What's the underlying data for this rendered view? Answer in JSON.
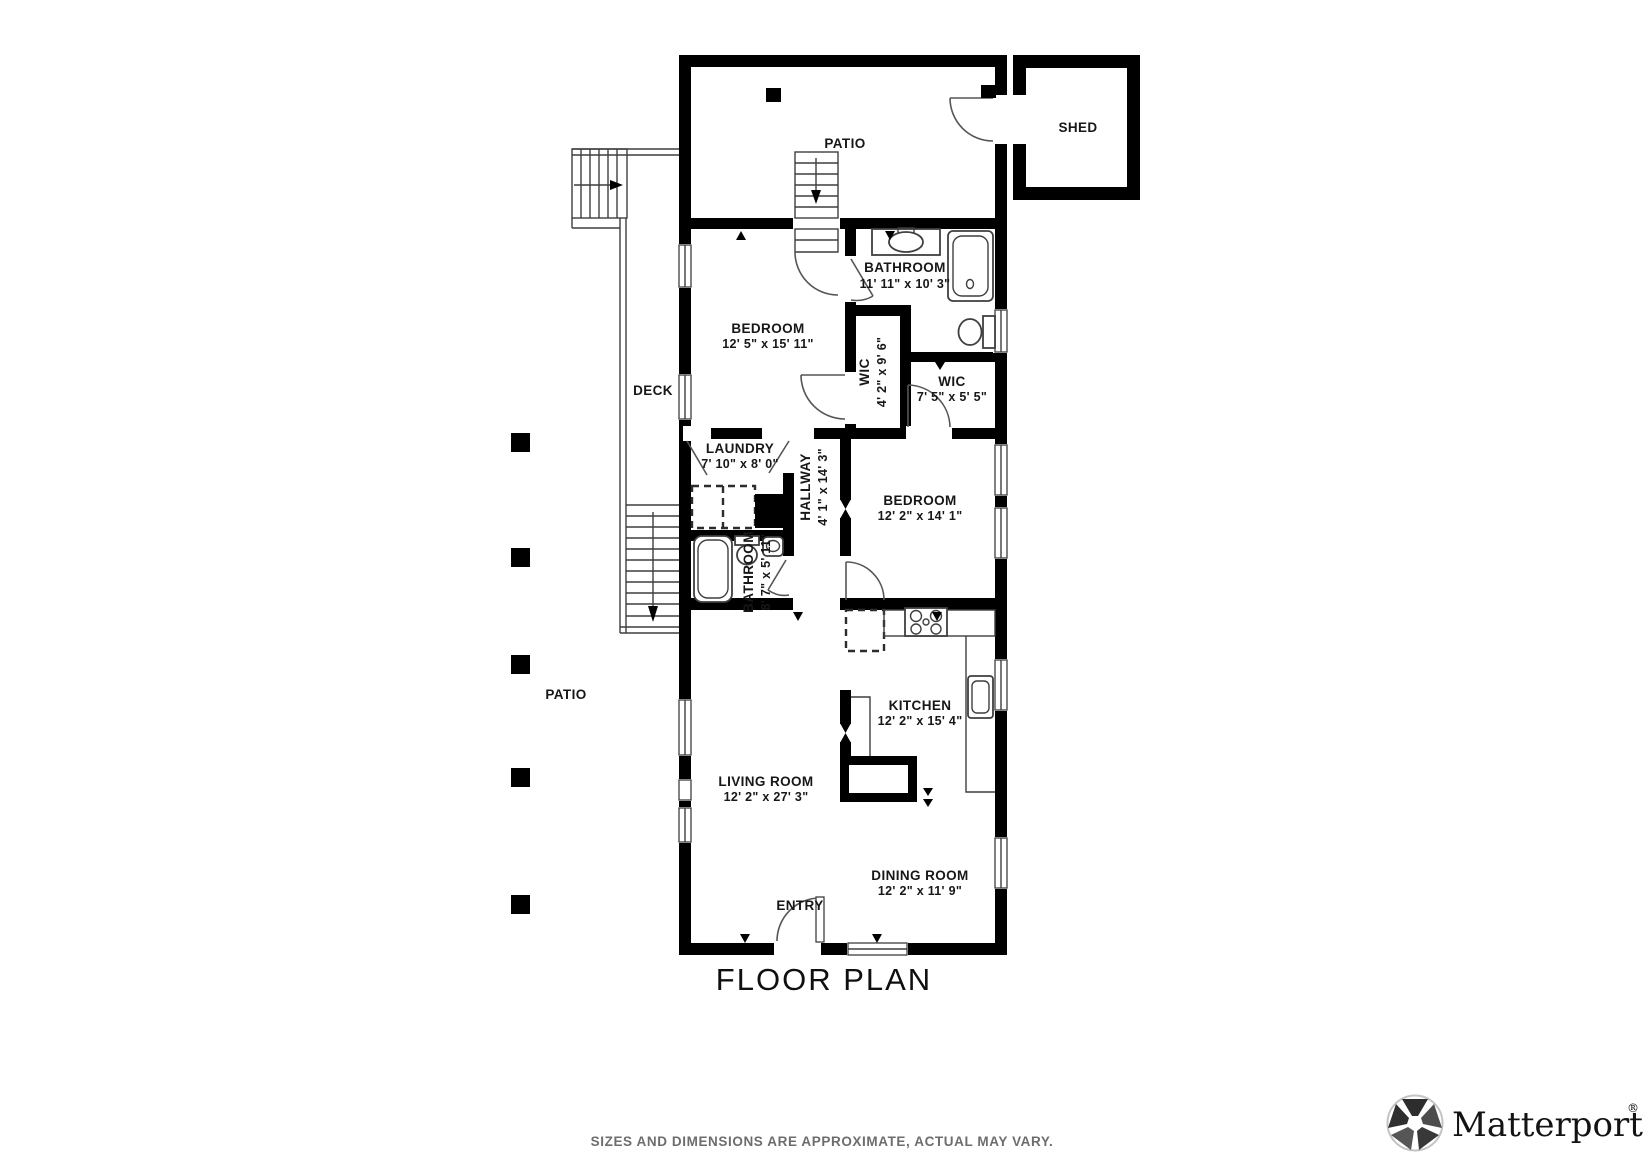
{
  "title": "FLOOR PLAN",
  "disclaimer": "SIZES AND DIMENSIONS ARE APPROXIMATE, ACTUAL MAY VARY.",
  "brand": {
    "wordmark": "Matterport",
    "registered_mark": "®",
    "icon": "matterport-pinwheel-icon"
  },
  "colors": {
    "walls": "#000000",
    "fixture_lines": "#3f3f3f",
    "label_text": "#171717",
    "muted_text": "#6d6d6d"
  },
  "rooms": {
    "patio_top": {
      "label": "PATIO"
    },
    "shed": {
      "label": "SHED"
    },
    "bathroom_top": {
      "label": "BATHROOM",
      "dims": "11' 11\" x 10' 3\""
    },
    "bedroom_top": {
      "label": "BEDROOM",
      "dims": "12' 5\" x 15' 11\""
    },
    "wic_left": {
      "label": "WIC",
      "dims": "4' 2\" x 9' 6\""
    },
    "wic_right": {
      "label": "WIC",
      "dims": "7' 5\" x 5' 5\""
    },
    "deck": {
      "label": "DECK"
    },
    "laundry": {
      "label": "LAUNDRY",
      "dims": "7' 10\" x 8' 0\""
    },
    "hallway": {
      "label": "HALLWAY",
      "dims": "4' 1\" x 14' 3\""
    },
    "bedroom_mid": {
      "label": "BEDROOM",
      "dims": "12' 2\" x 14' 1\""
    },
    "bathroom_mid": {
      "label": "BATHROOM",
      "dims": "8' 7\" x 5' 11\""
    },
    "patio_left": {
      "label": "PATIO"
    },
    "kitchen": {
      "label": "KITCHEN",
      "dims": "12' 2\" x 15' 4\""
    },
    "living_room": {
      "label": "LIVING ROOM",
      "dims": "12' 2\" x 27' 3\""
    },
    "dining_room": {
      "label": "DINING ROOM",
      "dims": "12' 2\" x 11' 9\""
    },
    "entry": {
      "label": "ENTRY"
    }
  }
}
